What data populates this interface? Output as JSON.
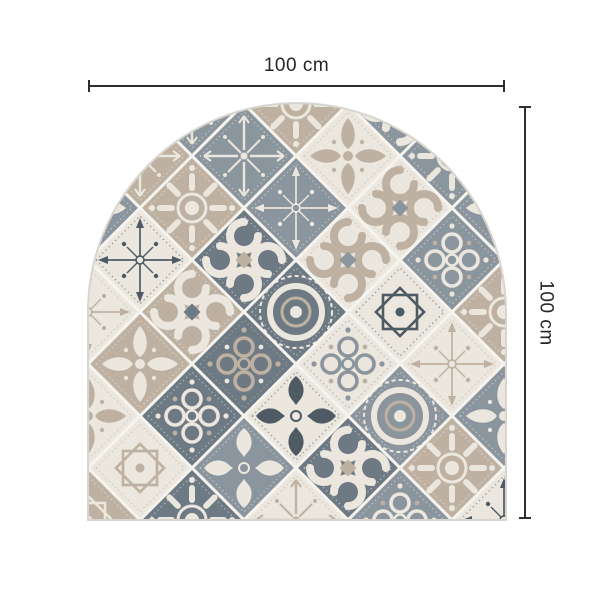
{
  "figure": {
    "kind": "product dimension diagram",
    "product_shape": "arched patchwork tile mat"
  },
  "dimensions": {
    "width_label": "100 cm",
    "height_label": "100 cm",
    "line_color": "#2e2e2e",
    "text_color": "#262626"
  },
  "mat": {
    "shape": "arch",
    "palette": {
      "grout": "#f5f3ee",
      "grayD": "#6d7a84",
      "gray": "#8b959d",
      "taupe": "#bfb1a1",
      "taupeL": "#d6ccc0",
      "cream": "#ebe7de",
      "ink": "#4e5a64",
      "edge": "#d8d5cf"
    },
    "tiles": [
      {
        "i": 0,
        "j": 0,
        "bg": "cream",
        "fg": "taupe",
        "motif": "rosette"
      },
      {
        "i": 2,
        "j": 0,
        "bg": "gray",
        "fg": "cream",
        "motif": "snowflake"
      },
      {
        "i": 4,
        "j": 0,
        "bg": "taupe",
        "fg": "cream",
        "motif": "rosette"
      },
      {
        "i": 6,
        "j": 0,
        "bg": "gray",
        "fg": "cream",
        "motif": "scroll",
        "ac": "taupe"
      },
      {
        "i": 8,
        "j": 0,
        "bg": "cream",
        "fg": "taupe",
        "motif": "star8"
      },
      {
        "i": 1,
        "j": 1,
        "bg": "taupe",
        "fg": "cream",
        "motif": "snowflake"
      },
      {
        "i": 3,
        "j": 1,
        "bg": "gray",
        "fg": "cream",
        "motif": "snowflake"
      },
      {
        "i": 5,
        "j": 1,
        "bg": "cream",
        "fg": "taupe",
        "motif": "fleur"
      },
      {
        "i": 7,
        "j": 1,
        "bg": "gray",
        "fg": "cream",
        "motif": "rosette"
      },
      {
        "i": 0,
        "j": 2,
        "bg": "gray",
        "fg": "cream",
        "motif": "fleur"
      },
      {
        "i": 2,
        "j": 2,
        "bg": "taupe",
        "fg": "cream",
        "motif": "rosette"
      },
      {
        "i": 4,
        "j": 2,
        "bg": "gray",
        "fg": "cream",
        "motif": "compass"
      },
      {
        "i": 6,
        "j": 2,
        "bg": "cream",
        "fg": "taupe",
        "motif": "scroll",
        "ac": "gray"
      },
      {
        "i": 8,
        "j": 2,
        "bg": "gray",
        "fg": "cream",
        "motif": "fleur"
      },
      {
        "i": 1,
        "j": 3,
        "bg": "cream",
        "fg": "ink",
        "motif": "compass"
      },
      {
        "i": 3,
        "j": 3,
        "bg": "grayD",
        "fg": "cream",
        "motif": "scroll",
        "ac": "taupe"
      },
      {
        "i": 5,
        "j": 3,
        "bg": "cream",
        "fg": "taupe",
        "motif": "scroll",
        "ac": "gray"
      },
      {
        "i": 7,
        "j": 3,
        "bg": "gray",
        "fg": "cream",
        "motif": "circles",
        "ac": "taupe"
      },
      {
        "i": 0,
        "j": 4,
        "bg": "cream",
        "fg": "taupe",
        "motif": "compass"
      },
      {
        "i": 2,
        "j": 4,
        "bg": "taupe",
        "fg": "cream",
        "motif": "scroll",
        "ac": "grayD"
      },
      {
        "i": 4,
        "j": 4,
        "bg": "grayD",
        "fg": "cream",
        "motif": "medallion",
        "ac": "taupe"
      },
      {
        "i": 6,
        "j": 4,
        "bg": "cream",
        "fg": "ink",
        "motif": "star8"
      },
      {
        "i": 8,
        "j": 4,
        "bg": "taupe",
        "fg": "cream",
        "motif": "rosette"
      },
      {
        "i": 1,
        "j": 5,
        "bg": "taupe",
        "fg": "cream",
        "motif": "fleur"
      },
      {
        "i": 3,
        "j": 5,
        "bg": "grayD",
        "fg": "taupe",
        "motif": "circles",
        "ac": "cream"
      },
      {
        "i": 5,
        "j": 5,
        "bg": "cream",
        "fg": "gray",
        "motif": "circles",
        "ac": "taupe"
      },
      {
        "i": 7,
        "j": 5,
        "bg": "cream",
        "fg": "taupe",
        "motif": "compass"
      },
      {
        "i": 0,
        "j": 6,
        "bg": "cream",
        "fg": "taupe",
        "motif": "fleur"
      },
      {
        "i": 2,
        "j": 6,
        "bg": "grayD",
        "fg": "cream",
        "motif": "circles",
        "ac": "taupe"
      },
      {
        "i": 4,
        "j": 6,
        "bg": "cream",
        "fg": "ink",
        "motif": "tulip"
      },
      {
        "i": 6,
        "j": 6,
        "bg": "gray",
        "fg": "cream",
        "motif": "medallion",
        "ac": "taupe"
      },
      {
        "i": 8,
        "j": 6,
        "bg": "gray",
        "fg": "cream",
        "motif": "fleur"
      },
      {
        "i": 1,
        "j": 7,
        "bg": "cream",
        "fg": "taupe",
        "motif": "star8"
      },
      {
        "i": 3,
        "j": 7,
        "bg": "gray",
        "fg": "cream",
        "motif": "tulip"
      },
      {
        "i": 5,
        "j": 7,
        "bg": "grayD",
        "fg": "cream",
        "motif": "scroll",
        "ac": "taupe"
      },
      {
        "i": 7,
        "j": 7,
        "bg": "taupe",
        "fg": "cream",
        "motif": "rosette"
      },
      {
        "i": 0,
        "j": 8,
        "bg": "taupe",
        "fg": "cream",
        "motif": "star8"
      },
      {
        "i": 2,
        "j": 8,
        "bg": "grayD",
        "fg": "cream",
        "motif": "rosette"
      },
      {
        "i": 4,
        "j": 8,
        "bg": "cream",
        "fg": "taupe",
        "motif": "snowflake"
      },
      {
        "i": 6,
        "j": 8,
        "bg": "gray",
        "fg": "cream",
        "motif": "circles",
        "ac": "taupe"
      },
      {
        "i": 8,
        "j": 8,
        "bg": "cream",
        "fg": "ink",
        "motif": "compass"
      }
    ]
  }
}
